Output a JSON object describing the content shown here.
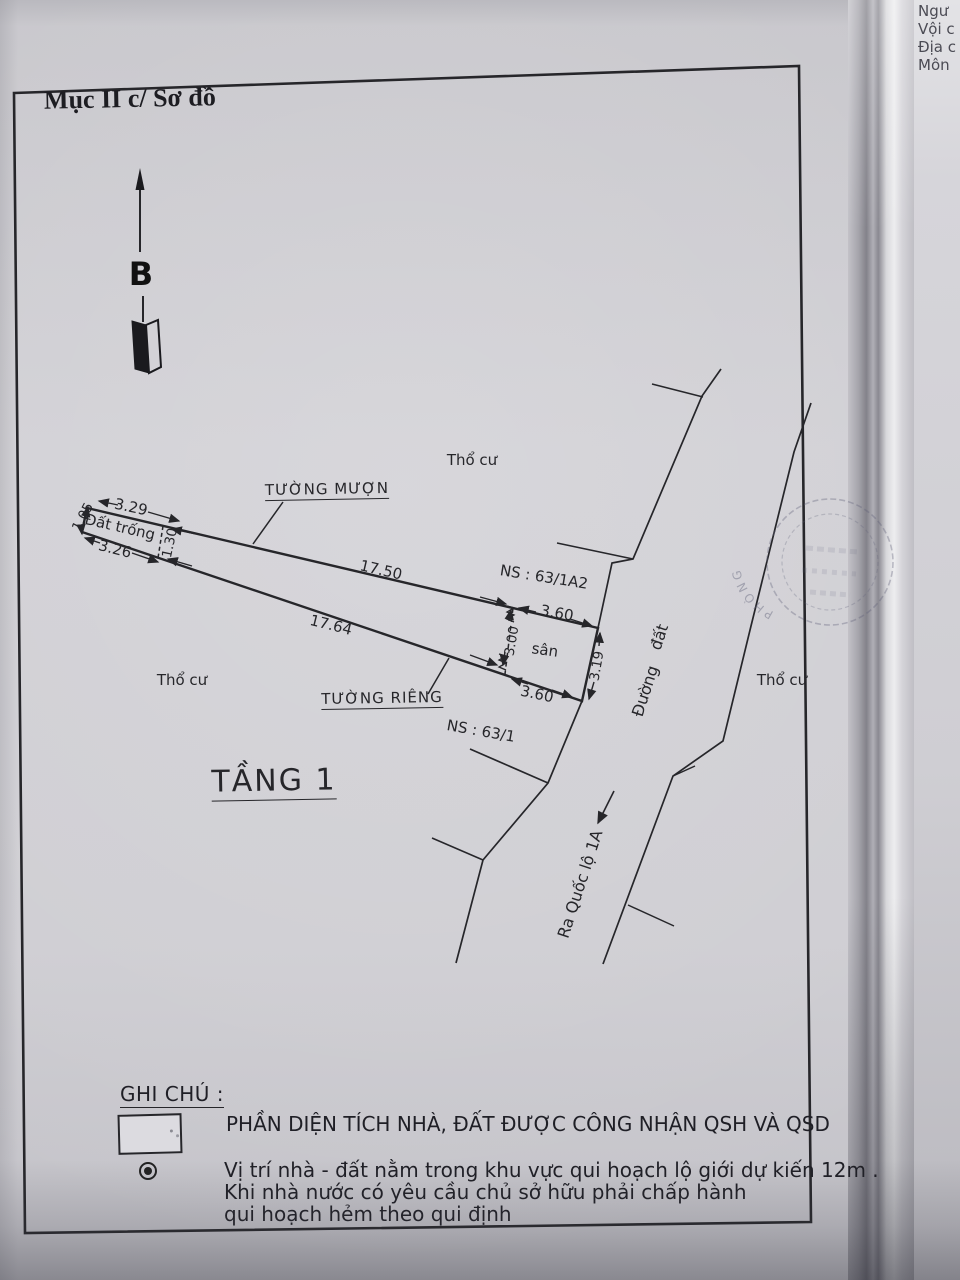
{
  "document": {
    "header": "Mục II c/ Sơ đồ",
    "north_label": "B"
  },
  "corner_fragments": [
    "Ngư",
    "Vội c",
    "Địa c",
    "Môn"
  ],
  "diagram": {
    "floor_label": "TẦNG 1",
    "labels": {
      "dat_trong": "Đất trống",
      "tho_cu": "Thổ cư",
      "tuong_muon": "TƯỜNG MƯỢN",
      "tuong_rieng": "TƯỜNG RIÊNG",
      "san": "sân",
      "duong": "Đường",
      "dat": "đất",
      "ra_quoc_lo": "Ra Quốc lộ 1A",
      "ns_63_1a2": "NS : 63/1A2",
      "ns_63_1": "NS : 63/1"
    },
    "dims": {
      "d105": "1.05",
      "d329": "3.29",
      "d326": "3.26",
      "d130": "1.30",
      "d1750": "17.50",
      "d1764": "17.64",
      "d360_top": "3.60",
      "d300": "3.00",
      "d319": "3.19",
      "d360_bot": "3.60"
    }
  },
  "stamp": {
    "arc_text": "PHÒNG"
  },
  "legend": {
    "title": "GHI CHÚ :",
    "swatch_label": "PHẦN DIỆN TÍCH NHÀ, ĐẤT ĐƯỢC CÔNG NHẬN QSH VÀ QSD",
    "note_lines": [
      "Vị trí nhà - đất nằm trong khu vực qui hoạch lộ giới dự kiến 12m .",
      "Khi nhà nước có yêu cầu chủ sở hữu phải chấp hành",
      "qui hoạch hẻm theo qui định"
    ]
  },
  "colors": {
    "ink": "#26262a",
    "paper": "#cdccd1",
    "stamp": "#5f6078"
  }
}
